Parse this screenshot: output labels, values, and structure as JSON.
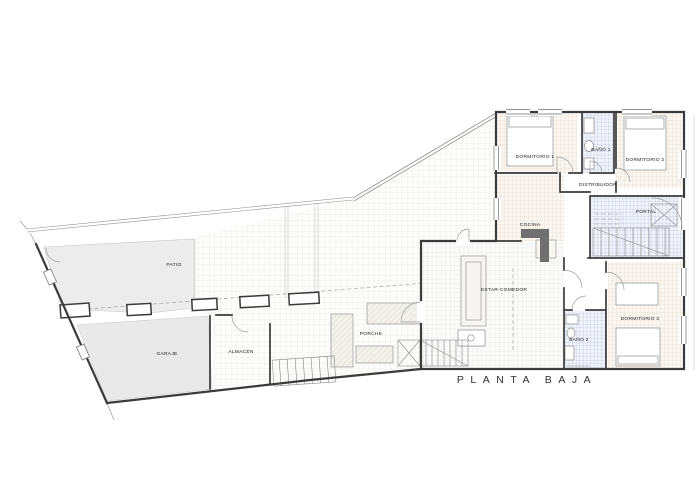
{
  "title": "PLANTA BAJA",
  "rooms": [
    {
      "id": "patio",
      "label": "PATIO"
    },
    {
      "id": "garaje",
      "label": "GARAJE"
    },
    {
      "id": "almacen",
      "label": "ALMACÉN"
    },
    {
      "id": "porche",
      "label": "PORCHE"
    },
    {
      "id": "estar-comedor",
      "label": "ESTAR-COMEDOR"
    },
    {
      "id": "cocina",
      "label": "COCINA"
    },
    {
      "id": "dormitorio-1",
      "label": "DORMITORIO 1"
    },
    {
      "id": "bano-1",
      "label": "BAÑO 1"
    },
    {
      "id": "dormitorio-2",
      "label": "DORMITORIO 2"
    },
    {
      "id": "distribuidor",
      "label": "DISTRIBUIDOR"
    },
    {
      "id": "portal",
      "label": "PORTAL"
    },
    {
      "id": "bano-2",
      "label": "BAÑO 2"
    },
    {
      "id": "dormitorio-3",
      "label": "DORMITORIO 3"
    }
  ],
  "colors": {
    "wall": "#3b3b3b",
    "ink": "#222222",
    "warm-tile-line": "#e6cdbb",
    "bath-tile-line": "#a9b2d6",
    "court-tile-line": "#e4e2de",
    "patio-fill": "#ececec",
    "garage-fill": "#e9e9e9"
  }
}
